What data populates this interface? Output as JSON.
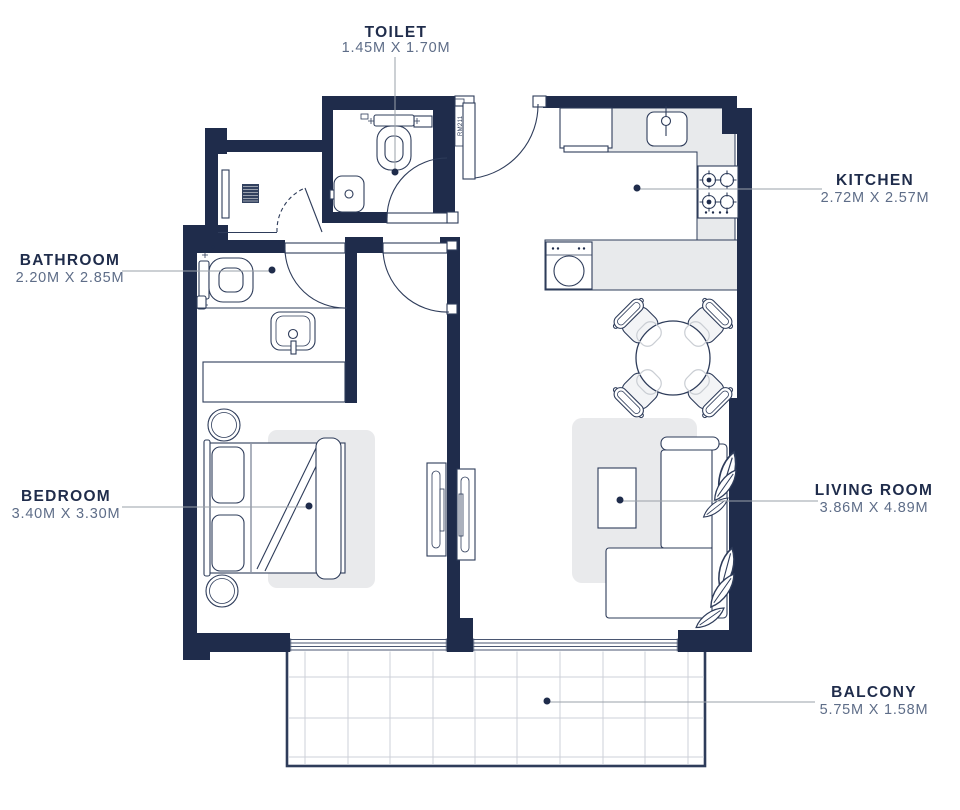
{
  "title": "Apartment floor plan",
  "unit_label": "RM211",
  "rooms": [
    {
      "id": "toilet",
      "name": "TOILET",
      "dimensions": "1.45M X 1.70M"
    },
    {
      "id": "kitchen",
      "name": "KITCHEN",
      "dimensions": "2.72M X 2.57M"
    },
    {
      "id": "bathroom",
      "name": "BATHROOM",
      "dimensions": "2.20M X 2.85M"
    },
    {
      "id": "bedroom",
      "name": "BEDROOM",
      "dimensions": "3.40M X 3.30M"
    },
    {
      "id": "living_room",
      "name": "LIVING ROOM",
      "dimensions": "3.86M X 4.89M"
    },
    {
      "id": "balcony",
      "name": "BALCONY",
      "dimensions": "5.75M X 1.58M"
    }
  ],
  "colors": {
    "wall": "#1f2c4b",
    "fixture_line": "#2e3c5a",
    "counter_fill": "#e8eaec",
    "rug_fill": "#e9eaec",
    "leader_line": "#9aa0a8",
    "dimension_text": "#5e6d88",
    "tile_grid": "#cdd1d8"
  },
  "furniture_icons": [
    "toilet-icon",
    "toilet-paper-icon",
    "washbasin-icon",
    "shower-drain-icon",
    "shower-glass-icon",
    "fridge-icon",
    "kitchen-sink-icon",
    "stove-icon",
    "washing-machine-icon",
    "dining-table-icon",
    "dining-chair-icon",
    "sofa-icon",
    "plant-leaf-icon",
    "coffee-table-icon",
    "tv-unit-icon",
    "bed-icon",
    "pillow-icon",
    "nightstand-icon",
    "wardrobe-icon",
    "door-swing-icon",
    "sliding-door-icon",
    "balcony-tile-grid"
  ]
}
